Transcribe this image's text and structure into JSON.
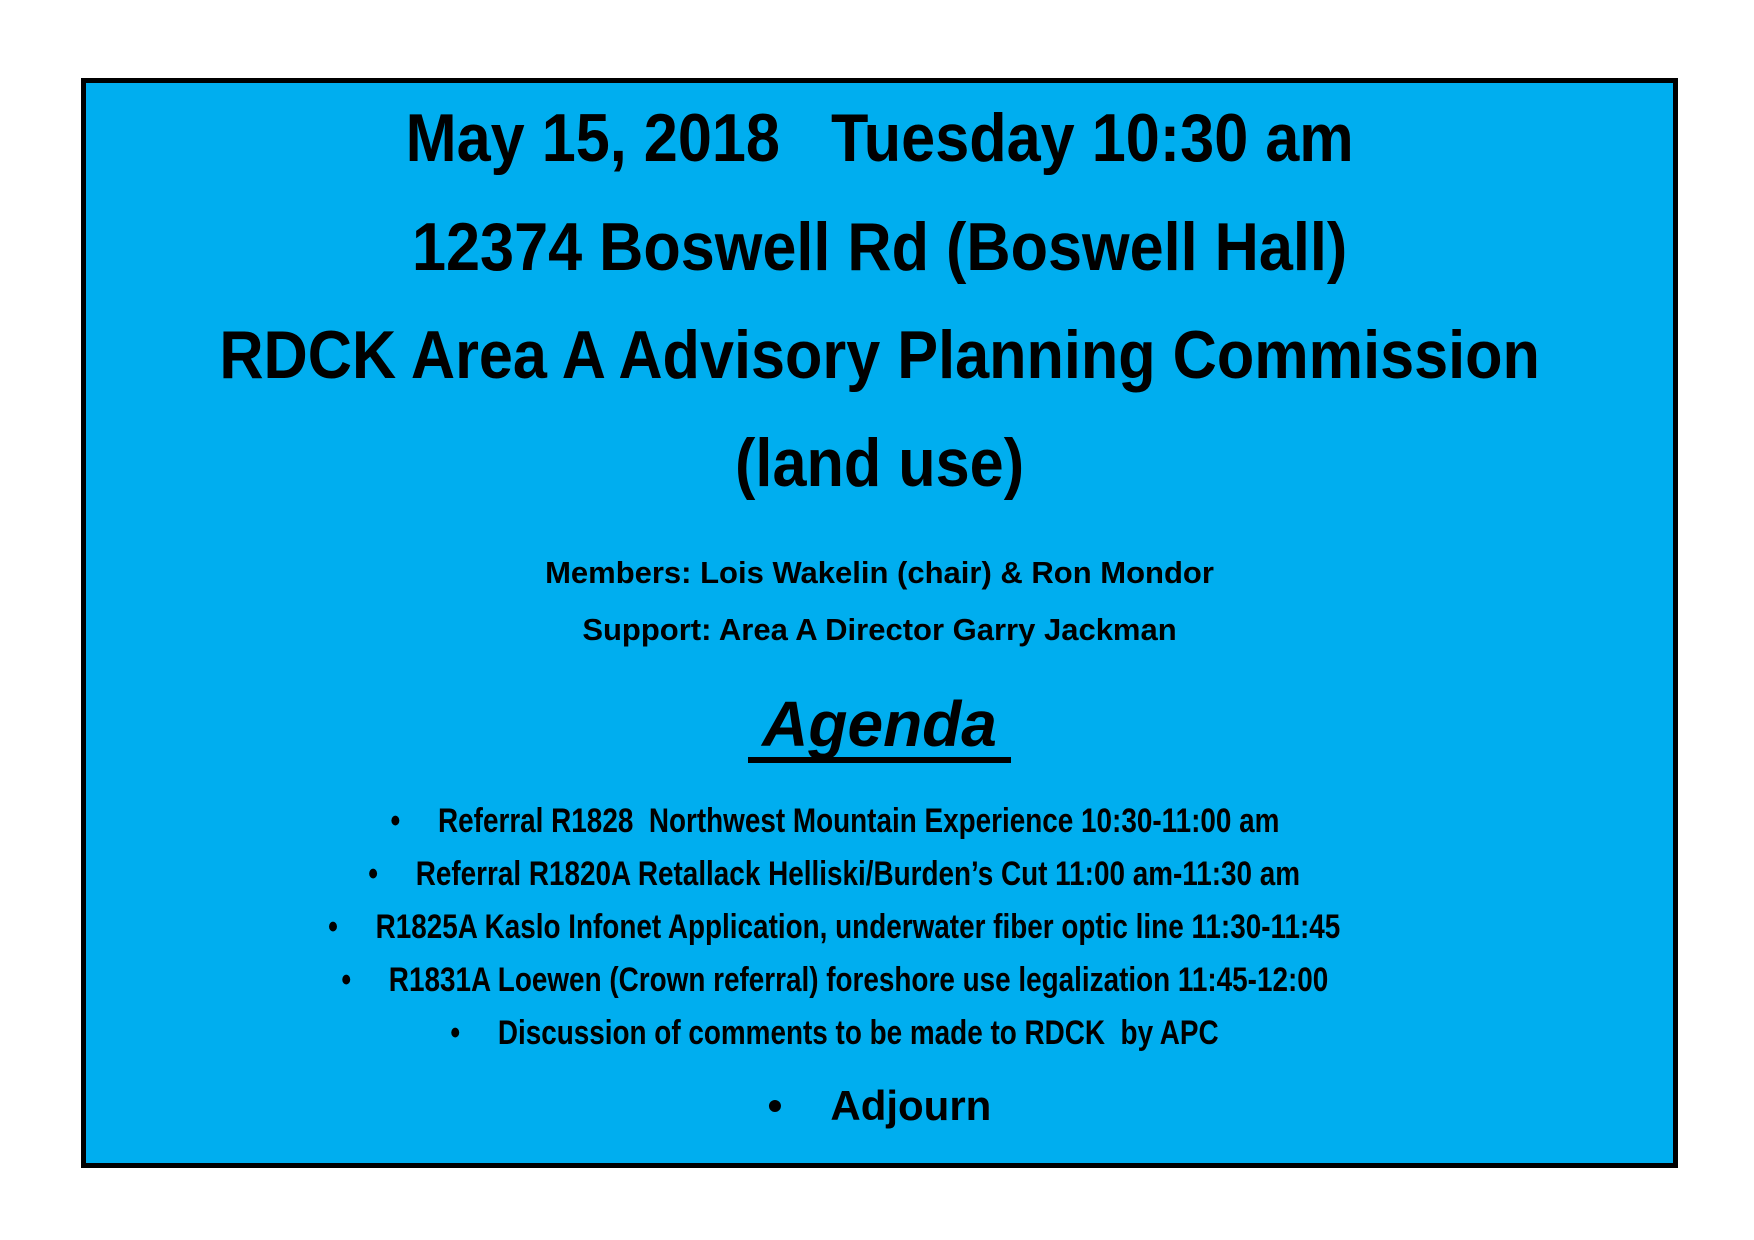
{
  "document": {
    "background_color": "#ffffff",
    "panel": {
      "fill_color": "#00AEEF",
      "border_color": "#000000",
      "text_color": "#000000"
    },
    "header": {
      "datetime_line": "May 15, 2018   Tuesday 10:30 am",
      "location_line": "12374 Boswell Rd (Boswell Hall)",
      "organization_line": "RDCK Area A Advisory Planning Commission",
      "subject_line": "(land use)"
    },
    "attendees": {
      "members_line": "Members: Lois Wakelin (chair) & Ron Mondor",
      "support_line": "Support: Area A Director Garry Jackman"
    },
    "agenda": {
      "title": "Agenda",
      "bullet_glyph": "•",
      "items": [
        "Referral R1828  Northwest Mountain Experience 10:30-11:00 am",
        "Referral R1820A Retallack Helliski/Burden’s Cut 11:00 am-11:30 am",
        "R1825A Kaslo Infonet Application, underwater fiber optic line 11:30-11:45",
        "R1831A Loewen (Crown referral) foreshore use legalization 11:45-12:00",
        "Discussion of comments to be made to RDCK  by APC"
      ],
      "closing_item": "Adjourn"
    }
  }
}
